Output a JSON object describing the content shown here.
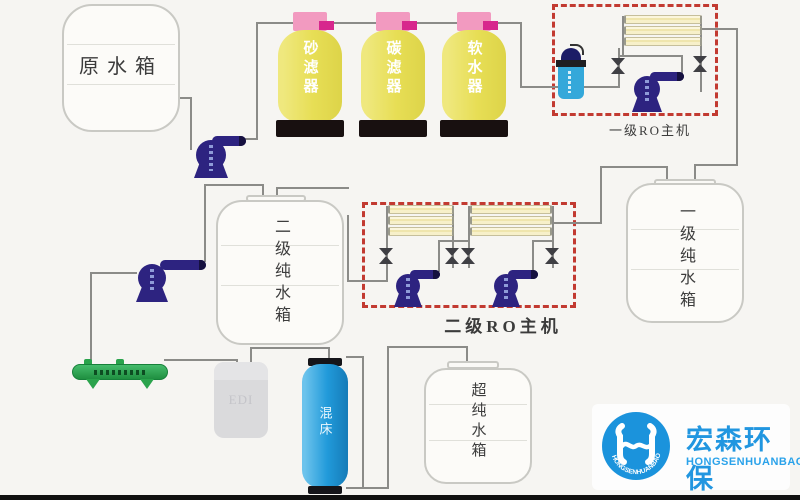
{
  "diagram": {
    "raw_tank_label": "原水箱",
    "filters": [
      "砂滤器",
      "碳滤器",
      "软水器"
    ],
    "ro1_label": "一级RO主机",
    "ro2_label": "二级RO主机",
    "stage1_tank_label": "一级纯水箱",
    "stage2_tank_label": "二级纯水箱",
    "ultra_tank_label": "超纯水箱",
    "edi_label": "EDI",
    "mixed_bed_label": "混床"
  },
  "logo": {
    "cn": "宏森环保",
    "en": "HONGSENHUANBAO",
    "ring_text": "HONGSENHUANBAO"
  },
  "colors": {
    "vessel_yellow": "#e7de55",
    "cap_pink": "#f29ac0",
    "valve_magenta": "#d7278d",
    "pump_indigo": "#2d2380",
    "membrane_cream": "#f7f0c9",
    "dashed_red": "#c23a31",
    "pipe_gray": "#8b8b88",
    "mixed_bed_blue": "#219ada",
    "edi_gray": "#dadadc",
    "manifold_green": "#2aa34c",
    "logo_blue": "#2196e0"
  }
}
